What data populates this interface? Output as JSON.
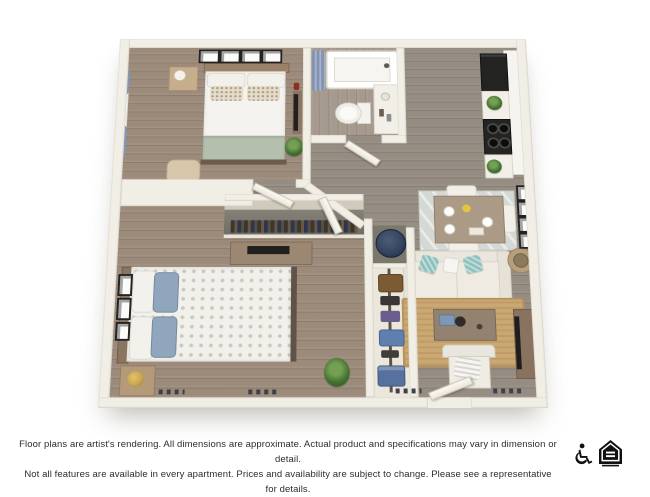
{
  "disclaimer": {
    "line1": "Floor plans are artist's rendering. All dimensions are approximate. Actual product and specifications may vary in dimension or detail.",
    "line2": "Not all features are available in every apartment. Prices and availability are subject to change. Please see a representative for details."
  },
  "footer": {
    "icons": [
      {
        "name": "wheelchair-accessible-icon"
      },
      {
        "name": "equal-housing-opportunity-icon"
      }
    ]
  },
  "floor_plan": {
    "description": "3D top-down artist rendering of a two bedroom, one bath apartment",
    "rooms": [
      {
        "name": "bedroom-1",
        "furniture": [
          "bed with sage green throw blanket",
          "nightstand with lamp",
          "four wall picture frames",
          "window with blue curtains",
          "tv on stand with red vase",
          "tan accent chair",
          "potted plant"
        ]
      },
      {
        "name": "bathroom",
        "furniture": [
          "bathtub with blue shower curtain",
          "toilet",
          "white vanity"
        ]
      },
      {
        "name": "kitchen",
        "furniture": [
          "black refrigerator",
          "black range with cooktop burners",
          "white cabinets and counters",
          "two potted plants"
        ]
      },
      {
        "name": "living-dining",
        "furniture": [
          "dining table with white plates and yellow flowers",
          "patterned dining rug",
          "white sofa with teal pillows",
          "round side table with drum lamp",
          "jute area rug",
          "coffee table with decor",
          "white accent chair with pillow",
          "media console with tv",
          "four gallery frames on right wall"
        ]
      },
      {
        "name": "bedroom-2",
        "furniture": [
          "bed with white floral duvet and blue pillows",
          "dresser with tv",
          "nightstand with gold lamp",
          "three wall picture frames",
          "potted plant",
          "wide closet with shelf and hanging clothes"
        ]
      },
      {
        "name": "hall-and-closets",
        "furniture": [
          "water heater closet with navy tank",
          "tall closet with hanging clothes",
          "open white interior doors",
          "open entry door"
        ]
      }
    ],
    "colors": {
      "wall": "#f1eee5",
      "bedroom_floor": "#9c8b7b",
      "living_floor": "#958c82",
      "bath_floor": "#a59a8d",
      "sofa": "#eae6dd",
      "teal_pillow": "#8fc0bd",
      "sage_blanket": "#b5bfae",
      "blue_pillow": "#8fa6bd",
      "jute_rug": "#c9a873",
      "dining_rug": "#d5d9d5",
      "appliance_black": "#232321",
      "water_heater_navy": "#36455f",
      "curtain_blue": "#7e95bd",
      "wood_accent": "#a08970"
    }
  }
}
